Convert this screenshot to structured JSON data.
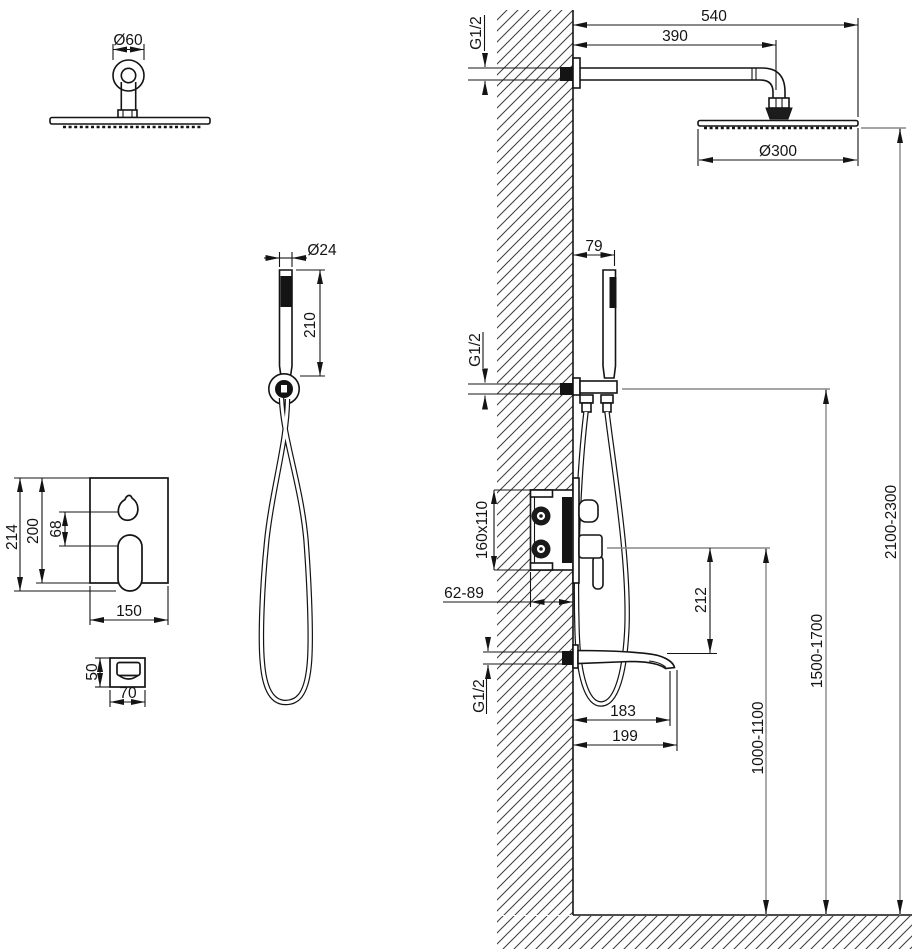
{
  "document": {
    "kind": "technical installation drawing",
    "subject": "concealed shower system with overhead shower, hand shower, mixer valve and bath spout"
  },
  "colors": {
    "line": "#141414",
    "reference_line": "#878787",
    "hatch": "#3a3a3a",
    "background": "#ffffff"
  },
  "labels": {
    "front": {
      "arm_flange_diameter": "Ø60",
      "handshower_diameter": "Ø24",
      "handshower_length": "210",
      "trim_total_height": "214",
      "trim_height": "200",
      "control_spacing": "68",
      "trim_width": "150",
      "spout_height": "50",
      "spout_width": "70"
    },
    "side": {
      "arm_thread": "G1/2",
      "arm_total_reach": "540",
      "arm_length": "390",
      "head_diameter": "Ø300",
      "handshower_offset": "79",
      "handshower_thread": "G1/2",
      "valve_box_size": "160x110",
      "valve_depth_range": "62-89",
      "spout_thread": "G1/2",
      "valve_to_spout": "212",
      "spout_outlet_reach": "183",
      "spout_total_reach": "199",
      "valve_height_range": "1000-1100",
      "handshower_height_range": "1500-1700",
      "head_height_range": "2100-2300"
    }
  }
}
